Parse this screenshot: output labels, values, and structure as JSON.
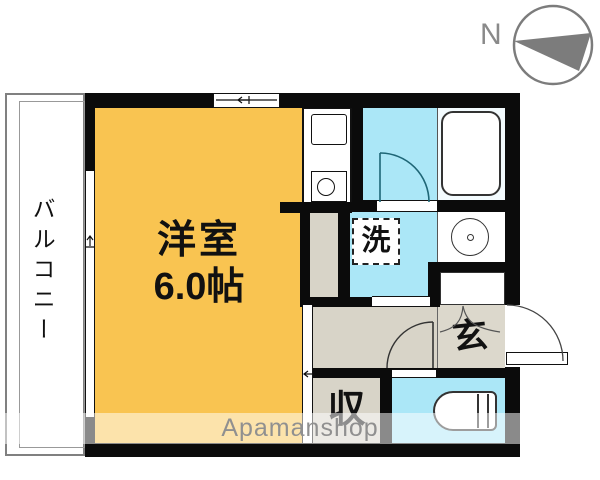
{
  "labels": {
    "room_name": "洋室",
    "room_size": "6.0帖",
    "balcony": "バルコニー",
    "washer": "洗",
    "entrance": "玄",
    "storage": "収",
    "compass": "N",
    "watermark": "Apamanshop"
  },
  "colors": {
    "room_fill": "#F9C451",
    "wet_fill": "#ABE7F7",
    "hall_fill": "#D8D4C8",
    "wall": "#0B0B0B",
    "line": "#333333",
    "bath_door_line": "#1E6676",
    "compass_gray": "#7C7C7C",
    "balcony_line": "#808080",
    "watermark_text": "#909090",
    "watermark_band": "rgba(255,255,255,0.52)"
  }
}
